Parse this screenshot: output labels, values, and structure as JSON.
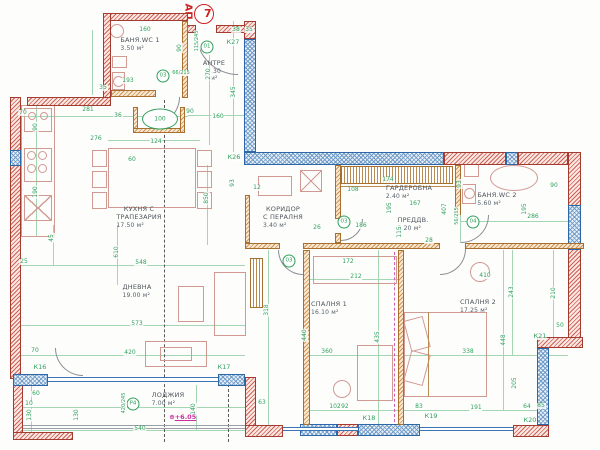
{
  "title": {
    "prefix": "АП.",
    "number": "7"
  },
  "rooms": [
    {
      "name": "БАНЯ.WC 1",
      "area": "3.50 м²",
      "x": 140,
      "y": 41
    },
    {
      "name": "АНТРЕ",
      "area": "4.30 м²",
      "x": 214,
      "y": 64
    },
    {
      "name": "КУХНЯ С\nТРАПЕЗАРИЯ",
      "area": "17.50 м²",
      "x": 139,
      "y": 214
    },
    {
      "name": "КОРИДОР\nС ПЕРАЛНЯ",
      "area": "3.40 м²",
      "x": 283,
      "y": 214
    },
    {
      "name": "ГАРДЕРОБНА",
      "area": "2.40 м²",
      "x": 409,
      "y": 189
    },
    {
      "name": "ПРЕДДВ.",
      "area": "3.20 м²",
      "x": 413,
      "y": 221
    },
    {
      "name": "БАНЯ.WC 2",
      "area": "5.60 м²",
      "x": 497,
      "y": 196
    },
    {
      "name": "ДНЕВНА",
      "area": "19.00 м²",
      "x": 137,
      "y": 288
    },
    {
      "name": "СПАЛНЯ 1",
      "area": "16.10 м²",
      "x": 329,
      "y": 305
    },
    {
      "name": "СПАЛНЯ 2",
      "area": "17.25 м²",
      "x": 478,
      "y": 303
    },
    {
      "name": "ЛОДЖИЯ",
      "area": "7.00 м²",
      "x": 168,
      "y": 396
    }
  ],
  "window_markers": [
    {
      "label": "К16",
      "x": 40,
      "y": 367
    },
    {
      "label": "К17",
      "x": 224,
      "y": 367
    },
    {
      "label": "К18",
      "x": 369,
      "y": 418
    },
    {
      "label": "К19",
      "x": 431,
      "y": 416
    },
    {
      "label": "К20",
      "x": 530,
      "y": 420
    },
    {
      "label": "К21",
      "x": 540,
      "y": 336
    },
    {
      "label": "К26",
      "x": 234,
      "y": 157
    },
    {
      "label": "К27",
      "x": 233,
      "y": 42
    }
  ],
  "door_tags": [
    {
      "label": "01",
      "size": "115/245",
      "x": 207,
      "y": 47,
      "sx": 197,
      "sy": 41,
      "sv": true
    },
    {
      "label": "03",
      "size": "66/215",
      "x": 163,
      "y": 76,
      "sx": 181,
      "sy": 73,
      "sv": false
    },
    {
      "label": "03",
      "size": "",
      "x": 289,
      "y": 261
    },
    {
      "label": "03",
      "size": "",
      "x": 344,
      "y": 222
    },
    {
      "label": "04",
      "size": "56/215",
      "x": 473,
      "y": 222,
      "sx": 457,
      "sy": 216,
      "sv": true
    },
    {
      "label": "Р4",
      "size": "420/245",
      "x": 133,
      "y": 404,
      "sx": 124,
      "sy": 403,
      "sv": true
    }
  ],
  "shaft": {
    "label": "100",
    "x": 160,
    "y": 119
  },
  "elevation": {
    "symbol": "⊕",
    "label": "+6.05",
    "x": 172,
    "y": 417
  },
  "dimensions": [
    {
      "t": "160",
      "x": 145,
      "y": 30
    },
    {
      "t": "90",
      "x": 180,
      "y": 48,
      "v": true
    },
    {
      "t": "35",
      "x": 103,
      "y": 88
    },
    {
      "t": "193",
      "x": 128,
      "y": 81
    },
    {
      "t": "38",
      "x": 236,
      "y": 30
    },
    {
      "t": "35",
      "x": 249,
      "y": 30
    },
    {
      "t": "270",
      "x": 209,
      "y": 74,
      "v": true
    },
    {
      "t": "345",
      "x": 234,
      "y": 92,
      "v": true
    },
    {
      "t": "160",
      "x": 218,
      "y": 117
    },
    {
      "t": "90",
      "x": 190,
      "y": 112
    },
    {
      "t": "70",
      "x": 23,
      "y": 113
    },
    {
      "t": "281",
      "x": 88,
      "y": 110
    },
    {
      "t": "36",
      "x": 118,
      "y": 116
    },
    {
      "t": "90",
      "x": 36,
      "y": 127,
      "v": true
    },
    {
      "t": "276",
      "x": 96,
      "y": 139
    },
    {
      "t": "124",
      "x": 156,
      "y": 142
    },
    {
      "t": "60",
      "x": 132,
      "y": 160
    },
    {
      "t": "190",
      "x": 36,
      "y": 192,
      "v": true
    },
    {
      "t": "850",
      "x": 207,
      "y": 198,
      "v": true
    },
    {
      "t": "93",
      "x": 233,
      "y": 183,
      "v": true
    },
    {
      "t": "45",
      "x": 52,
      "y": 238,
      "v": true
    },
    {
      "t": "25",
      "x": 24,
      "y": 262
    },
    {
      "t": "548",
      "x": 141,
      "y": 263
    },
    {
      "t": "610",
      "x": 117,
      "y": 252,
      "v": true
    },
    {
      "t": "573",
      "x": 137,
      "y": 324
    },
    {
      "t": "420",
      "x": 130,
      "y": 353
    },
    {
      "t": "70",
      "x": 35,
      "y": 351
    },
    {
      "t": "60",
      "x": 36,
      "y": 394
    },
    {
      "t": "10",
      "x": 29,
      "y": 404
    },
    {
      "t": "130",
      "x": 30,
      "y": 415,
      "v": true
    },
    {
      "t": "130",
      "x": 77,
      "y": 415,
      "v": true
    },
    {
      "t": "540",
      "x": 140,
      "y": 429
    },
    {
      "t": "140",
      "x": 194,
      "y": 409,
      "v": true
    },
    {
      "t": "63",
      "x": 262,
      "y": 403
    },
    {
      "t": "192",
      "x": 343,
      "y": 407
    },
    {
      "t": "172",
      "x": 348,
      "y": 262
    },
    {
      "t": "212",
      "x": 356,
      "y": 277
    },
    {
      "t": "318",
      "x": 267,
      "y": 310,
      "v": true
    },
    {
      "t": "440",
      "x": 305,
      "y": 335,
      "v": true
    },
    {
      "t": "435",
      "x": 378,
      "y": 337,
      "v": true
    },
    {
      "t": "360",
      "x": 327,
      "y": 352
    },
    {
      "t": "102",
      "x": 335,
      "y": 407
    },
    {
      "t": "83",
      "x": 419,
      "y": 407
    },
    {
      "t": "174",
      "x": 388,
      "y": 180
    },
    {
      "t": "12",
      "x": 257,
      "y": 188
    },
    {
      "t": "108",
      "x": 353,
      "y": 190
    },
    {
      "t": "167",
      "x": 415,
      "y": 204
    },
    {
      "t": "195",
      "x": 390,
      "y": 208,
      "v": true
    },
    {
      "t": "115",
      "x": 400,
      "y": 232,
      "v": true
    },
    {
      "t": "186",
      "x": 361,
      "y": 226
    },
    {
      "t": "26",
      "x": 317,
      "y": 228
    },
    {
      "t": "28",
      "x": 429,
      "y": 241
    },
    {
      "t": "407",
      "x": 445,
      "y": 209,
      "v": true
    },
    {
      "t": "93",
      "x": 460,
      "y": 184,
      "v": true
    },
    {
      "t": "90",
      "x": 554,
      "y": 186
    },
    {
      "t": "195",
      "x": 525,
      "y": 209,
      "v": true
    },
    {
      "t": "286",
      "x": 533,
      "y": 217
    },
    {
      "t": "410",
      "x": 485,
      "y": 276
    },
    {
      "t": "243",
      "x": 512,
      "y": 292,
      "v": true
    },
    {
      "t": "210",
      "x": 554,
      "y": 293,
      "v": true
    },
    {
      "t": "448",
      "x": 504,
      "y": 340,
      "v": true
    },
    {
      "t": "338",
      "x": 468,
      "y": 352
    },
    {
      "t": "50",
      "x": 560,
      "y": 326
    },
    {
      "t": "205",
      "x": 515,
      "y": 383,
      "v": true
    },
    {
      "t": "191",
      "x": 476,
      "y": 408
    },
    {
      "t": "64",
      "x": 527,
      "y": 407
    },
    {
      "t": "85",
      "x": 541,
      "y": 406
    }
  ]
}
